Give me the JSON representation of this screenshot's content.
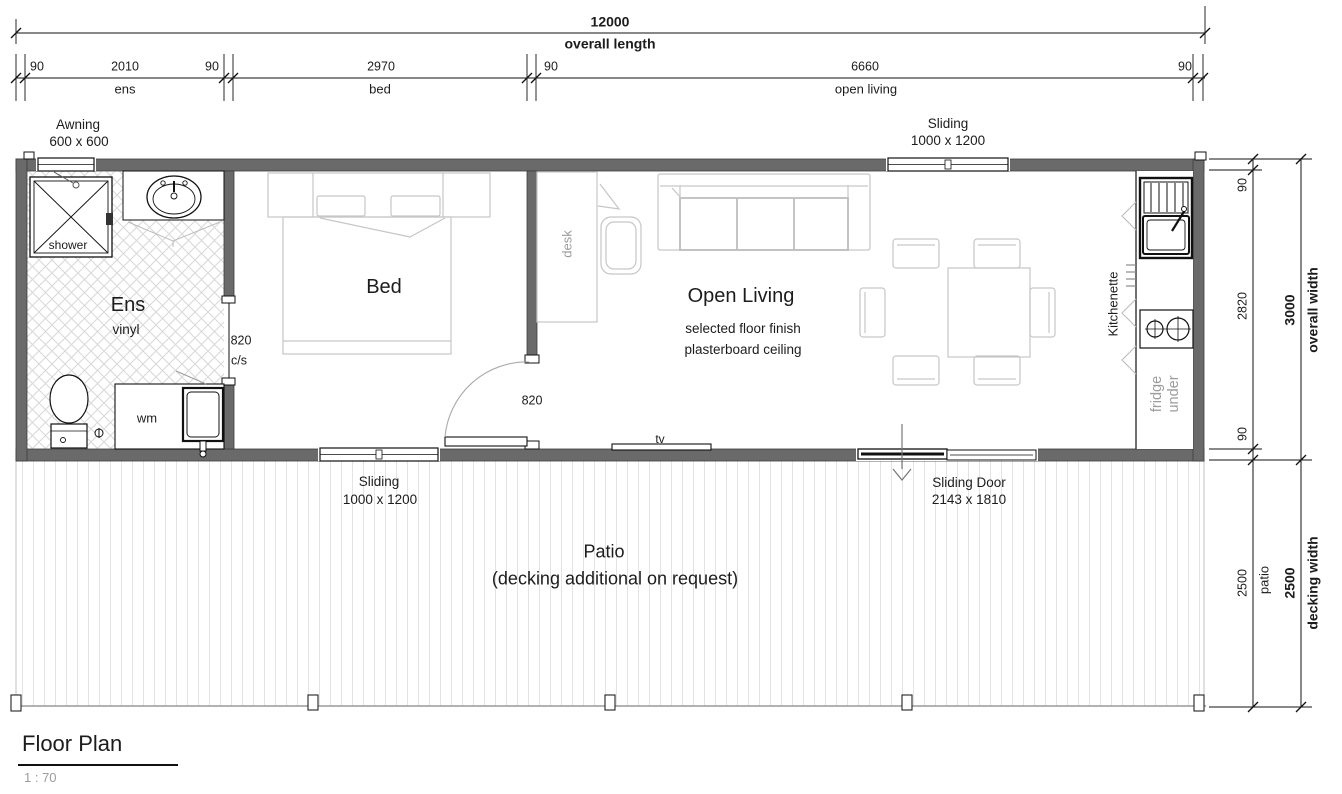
{
  "title_block": {
    "title": "Floor Plan",
    "scale": "1 : 70"
  },
  "dimensions": {
    "top_overall": {
      "value": "12000",
      "label": "overall length"
    },
    "top_segments": {
      "values": [
        "90",
        "2010",
        "90",
        "2970",
        "90",
        "6660",
        "90"
      ],
      "names": [
        "ens",
        "bed",
        "open living"
      ]
    },
    "right_inner": {
      "values": [
        "90",
        "2820",
        "90"
      ]
    },
    "right_patio": {
      "value": "2500",
      "name": "patio"
    },
    "right_overall": {
      "value": "3000",
      "label": "overall width"
    },
    "right_decking": {
      "value": "2500",
      "label": "decking width"
    }
  },
  "openings": {
    "awning": {
      "type": "Awning",
      "size": "600 x 600"
    },
    "sliding_top": {
      "type": "Sliding",
      "size": "1000 x 1200"
    },
    "sliding_bottom": {
      "type": "Sliding",
      "size": "1000 x 1200"
    },
    "sliding_door": {
      "type": "Sliding Door",
      "size": "2143 x 1810"
    },
    "ens_door": {
      "width": "820",
      "note": "c/s"
    },
    "bed_door": {
      "width": "820"
    }
  },
  "rooms": {
    "ens": {
      "name": "Ens",
      "floor": "vinyl"
    },
    "bed": {
      "name": "Bed"
    },
    "open_living": {
      "name": "Open Living",
      "notes": [
        "selected floor finish",
        "plasterboard ceiling"
      ]
    },
    "patio": {
      "name": "Patio",
      "note": "(decking additional on request)"
    },
    "kitchenette": {
      "name": "Kitchenette"
    }
  },
  "fixtures": {
    "shower": "shower",
    "washing_machine": "wm",
    "desk": "desk",
    "tv": "tv",
    "fridge_line1": "fridge",
    "fridge_line2": "under"
  }
}
